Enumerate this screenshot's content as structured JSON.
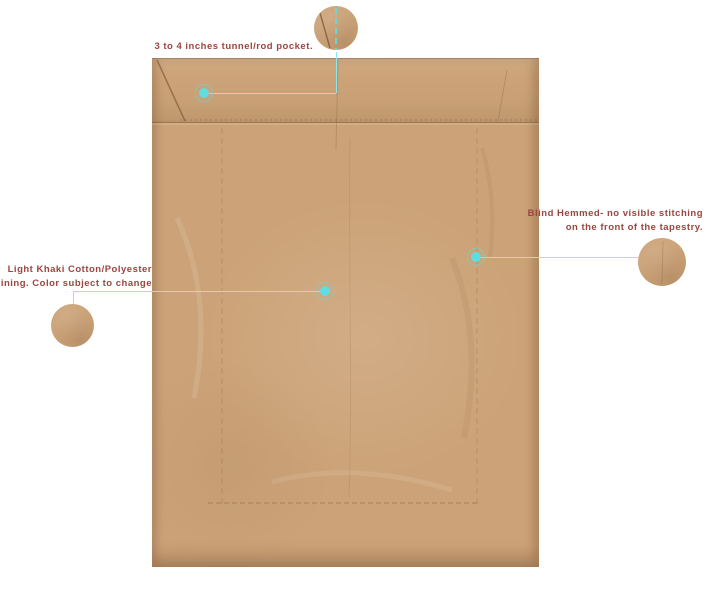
{
  "canvas": {
    "background": "#ffffff"
  },
  "colors": {
    "page_bg": "#ffffff",
    "fabric": "#cca378",
    "fabric_edge_shadow": "rgba(100,65,35,0.28)",
    "annotation_text": "#9c4540",
    "marker_fill": "#5fdde2",
    "marker_ring": "rgba(95,221,226,0.5)",
    "callout_line": "#8fe8ea"
  },
  "annotations": {
    "rod_pocket": {
      "text": "3 to 4 inches tunnel/rod pocket."
    },
    "blind_hem": {
      "line1": "Blind Hemmed- no visible stitching",
      "line2": "on the front of the tapestry."
    },
    "lining": {
      "line1": "Light Khaki Cotton/Polyester",
      "line2": "lining. Color subject to change"
    }
  }
}
